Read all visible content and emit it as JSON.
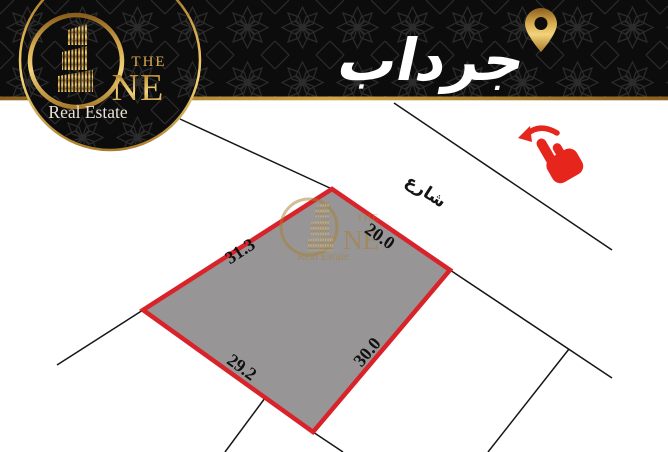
{
  "header": {
    "location_title": "جرداب",
    "logo": {
      "word_the": "THE",
      "word_ne": "NE",
      "subtitle": "Real Estate"
    }
  },
  "diagram": {
    "street_label": "شارع",
    "plot": {
      "edge_top_left": "31.3",
      "edge_top_right": "20.0",
      "edge_bottom_left": "29.2",
      "edge_bottom_right": "30.0"
    },
    "fill_color": "#979596",
    "border_color": "#d8232a"
  },
  "watermark": {
    "word_the": "THE",
    "word_ne": "NE",
    "subtitle": "Real Estate"
  },
  "icons": {
    "location_pin": "location-pin-icon",
    "swipe_hand": "swipe-left-hand-icon"
  },
  "colors": {
    "banner_black": "#0c0c0c",
    "gold": "#c89b3c",
    "hand_red": "#e6251c",
    "text_white": "#ffffff",
    "boundary_black": "#161616"
  }
}
